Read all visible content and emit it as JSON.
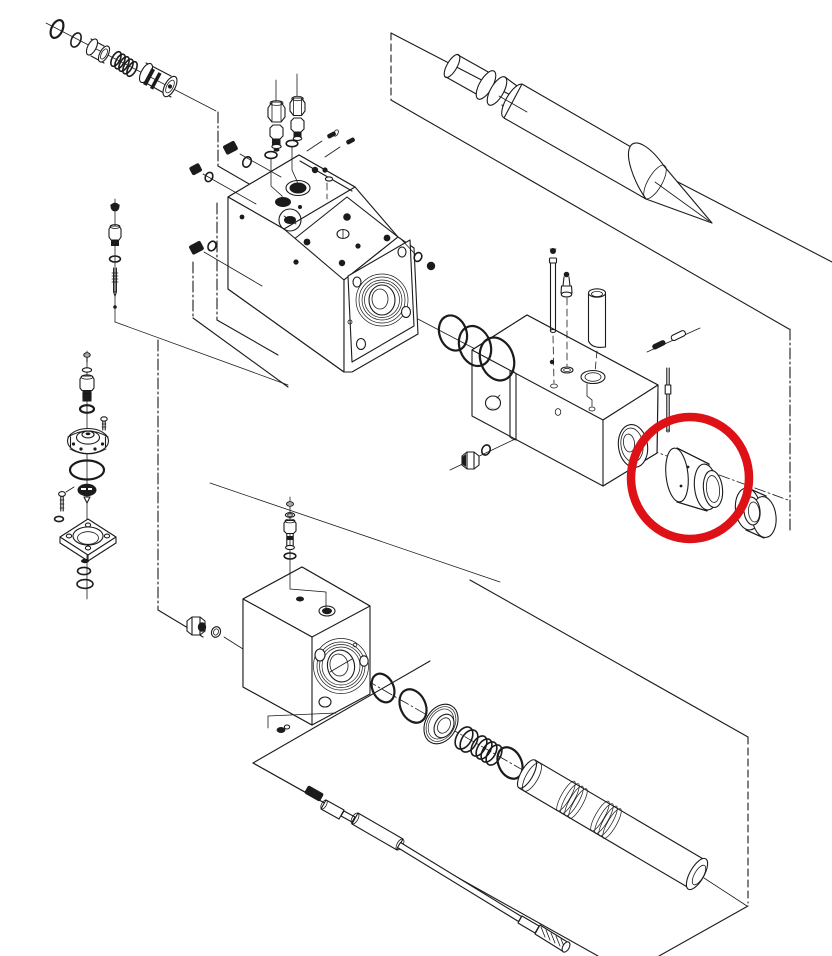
{
  "meta": {
    "title": "Hydraulic breaker exploded parts diagram",
    "type": "exploded-view technical illustration",
    "text_visible": "none"
  },
  "colors": {
    "background": "#ffffff",
    "line": "#1b1b1b",
    "highlight": "#de1117"
  },
  "highlight": {
    "shape": "circle",
    "color": "#de1117",
    "target_part": "front-head-bush"
  },
  "parts": [
    "control-valve-o-rings",
    "control-valve-bushing",
    "control-valve-spring",
    "control-valve-cartridge",
    "moil-point-chisel",
    "main-valve-block",
    "hex-cap-plug-1",
    "hex-cap-plug-2",
    "adapter-fitting-1",
    "adapter-fitting-2",
    "gasket-pad-bolt-holes",
    "threaded-side-port",
    "port-o-rings-trio",
    "side-plug-a",
    "side-plug-b",
    "side-plug-c",
    "pressure-adjuster-chain",
    "accumulator-charging-valve",
    "accumulator-cap",
    "accumulator-diaphragm",
    "accumulator-flange",
    "front-head-block",
    "stop-pin",
    "grease-fitting",
    "tool-retainer-pin",
    "spring-pin-pair",
    "dowel-pin",
    "front-head-bush",
    "thrust-ring-bush",
    "cylinder-block",
    "gas-charging-fitting",
    "plug-nut-and-washer",
    "drain-plug",
    "piston-o-rings",
    "seal-retainer-gland",
    "u-cup-seal",
    "buffer-seal-stack",
    "piston",
    "through-bolt"
  ]
}
